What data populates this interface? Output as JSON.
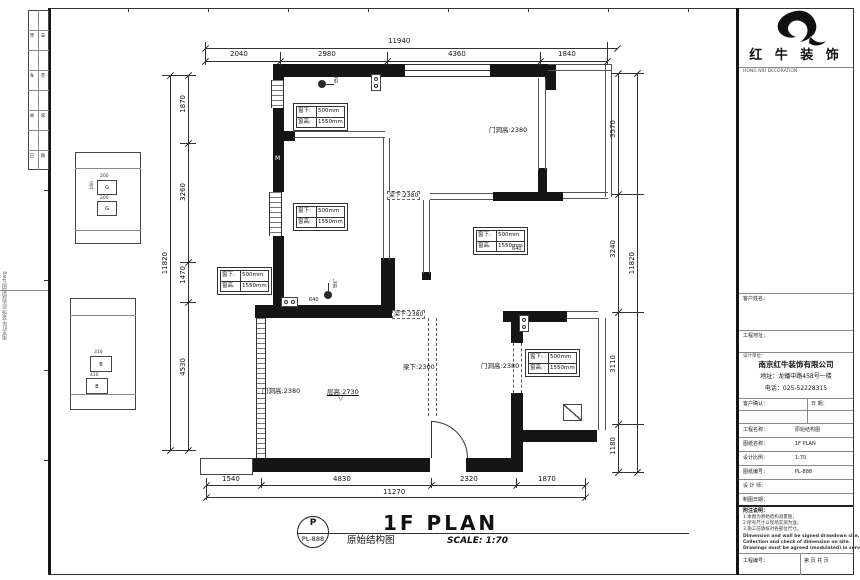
{
  "frame": {
    "side_text": "南京红牛装饰·原始结构图.dwg",
    "sign_rows": [
      [
        "会",
        "签"
      ],
      [
        "专",
        "业"
      ],
      [
        "审",
        "定"
      ],
      [
        "日",
        "期"
      ]
    ]
  },
  "legend": {
    "g1": "G",
    "g2": "B",
    "d1": "200",
    "d2": "160",
    "d3": "200",
    "d4": "310",
    "d5": "410"
  },
  "titleblock": {
    "logo_cn": "红 牛 装 饰",
    "logo_en": "HONG NIU DECORATION",
    "field_customer": "客户姓名：",
    "field_address": "工程地址：",
    "field_company_header": "设计单位：",
    "company_name": "南京红牛装饰有限公司",
    "company_address": "地址：龙蟠中路458号一楼",
    "company_phone": "电话：025-52228315",
    "confirm_label": "客户确认：",
    "confirm_date": "日 期：",
    "rows": [
      {
        "label": "工程名称：",
        "value": "原始结构图"
      },
      {
        "label": "图纸名称：",
        "value": "1F PLAN"
      },
      {
        "label": "设计比例：",
        "value": "1:70"
      },
      {
        "label": "图纸编号：",
        "value": "PL-888"
      },
      {
        "label": "设 计 师：",
        "value": ""
      },
      {
        "label": "制图日期：",
        "value": ""
      }
    ],
    "notes_title": "附注说明：",
    "notes": [
      "1.本图为原始结构测量图；",
      "2.所有尺寸以现场实测为准；",
      "3.施工前请核对各部位尺寸。"
    ],
    "notes_en": [
      "Dimension and wall be signed drawdown site.",
      "Collection and check of dimension on site.",
      "Drawings must be agreed (modulated) in service."
    ],
    "bottom_left": "工程编号：",
    "bottom_right": "第 页 共 页"
  },
  "plan": {
    "dims": {
      "top_total": "11940",
      "top": [
        "2040",
        "2980",
        "4360",
        "1840"
      ],
      "bottom": [
        "1540",
        "4830",
        "2320",
        "1870"
      ],
      "bottom_total": "11270",
      "left": [
        "1870",
        "3260",
        "1470",
        "4530"
      ],
      "left_total": "11820",
      "right": [
        "3570",
        "3240",
        "3110",
        "1180"
      ],
      "right_total": "11820"
    },
    "window_spec": {
      "l1": "窗下:",
      "v1": "500mm",
      "l2": "窗高:",
      "v2": "1550mm"
    },
    "labels": {
      "door_top": "门洞高:2380",
      "beam_top": "梁下:2380",
      "beam_mid": "梁下:2380",
      "beam_low": "梁下:2300",
      "door_right": "门洞高:2380",
      "door_left": "门洞高:2380",
      "floor_height": "层高:2730",
      "level_mark": "▽",
      "door_m": "M",
      "jamb1": "640",
      "jamb2": "640",
      "gas1": "煤气",
      "gas2": "煤气"
    }
  },
  "footer": {
    "bubble_top": "P",
    "bubble_code": "PL-888",
    "title_cn": "原始结构图",
    "title_main": "1F PLAN",
    "scale": "SCALE: 1:70"
  }
}
